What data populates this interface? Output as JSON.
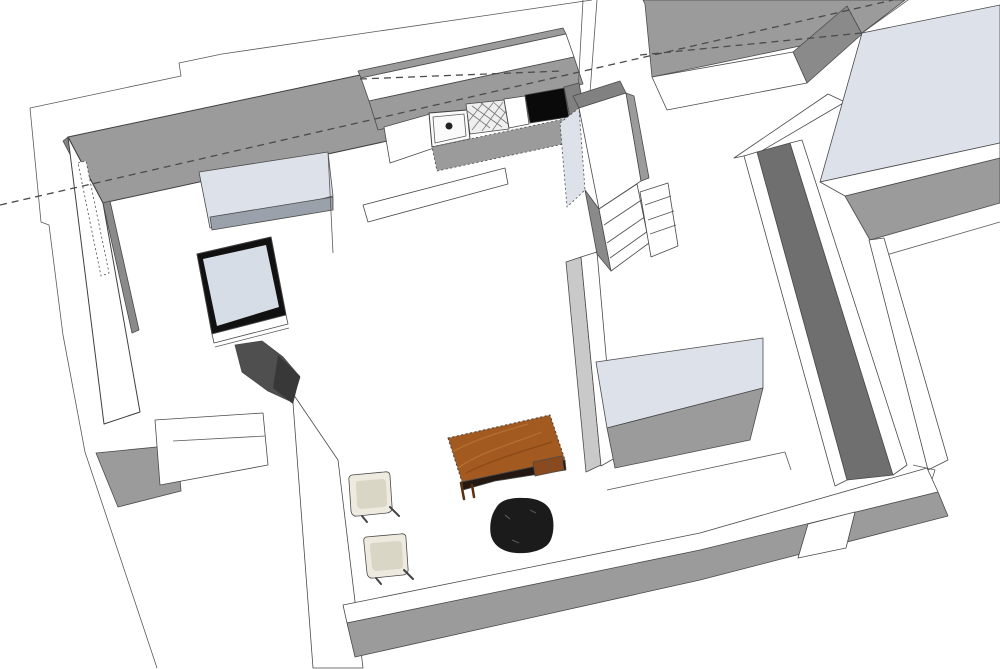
{
  "scene": {
    "kind": "3d-architectural-model",
    "style": "monochrome-sketch-render",
    "objects": [
      "floor-slab-outline",
      "section-dashed-line",
      "exterior-wall-top-left",
      "left-wall-window",
      "kitchen-counter",
      "kitchen-sink",
      "dish-drainer",
      "cooktop",
      "tall-cabinet",
      "wall-shelf",
      "tv-picture-frame",
      "armchair",
      "wooden-desk",
      "office-chair",
      "dining-chair",
      "dining-chair",
      "bathroom-counter",
      "bed",
      "interior-walls",
      "doorway-opening"
    ]
  },
  "colors": {
    "background": "#ffffff",
    "floor_white": "#ffffff",
    "wall_cut_top": "#9b9b9b",
    "wall_cut_dark": "#818181",
    "wall_inner_shadow": "#8a8a8a",
    "wall_face_light": "#c9c9c9",
    "wall_tall_dark": "#6f6f6f",
    "panel_blue_gray": "#dde2ea",
    "panel_blue_gray_edge": "#9aa1ab",
    "screen_blue_gray": "#d7dde6",
    "frame_black": "#111111",
    "cooktop_black": "#0a0a0a",
    "sink_white": "#fafafa",
    "drainer_bg": "#efefef",
    "drain_dark": "#222222",
    "desk_wood": "#a35a20",
    "desk_under_dark": "#241812",
    "drawer_wood": "#8a4a1e",
    "office_chair_black": "#1b1b1b",
    "armchair_gray": "#4f4f4f",
    "armchair_gray_dark": "#383838",
    "chair_cream": "#eeeadf",
    "chair_cream_inner": "#d9d6c6"
  }
}
